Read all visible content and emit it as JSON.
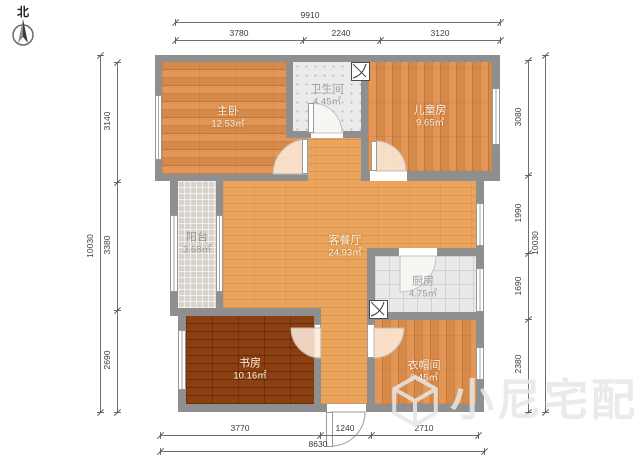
{
  "compass": {
    "north_label": "北"
  },
  "rooms": {
    "master": {
      "name": "主卧",
      "area": "12.53㎡"
    },
    "bathroom": {
      "name": "卫生间",
      "area": "4.45㎡"
    },
    "kids": {
      "name": "儿童房",
      "area": "9.65㎡"
    },
    "balcony": {
      "name": "阳台",
      "area": "3.68㎡"
    },
    "living": {
      "name": "客餐厅",
      "area": "24.93㎡"
    },
    "kitchen": {
      "name": "厨房",
      "area": "4.75㎡"
    },
    "study": {
      "name": "书房",
      "area": "10.16㎡"
    },
    "cloakroom": {
      "name": "衣帽间",
      "area": "6.45㎡"
    }
  },
  "dimensions": {
    "top": {
      "total": "9910",
      "segments": [
        "3780",
        "2240",
        "3120"
      ]
    },
    "bottom": {
      "total": "8630",
      "segments": [
        "3770",
        "1240",
        "2710"
      ]
    },
    "left": {
      "total": "10030",
      "segments": [
        "3140",
        "3380",
        "2690"
      ]
    },
    "right": {
      "total": "10030",
      "segments": [
        "3080",
        "1990",
        "1690",
        "2380"
      ]
    }
  },
  "watermark": {
    "text": "小尼宅配"
  }
}
